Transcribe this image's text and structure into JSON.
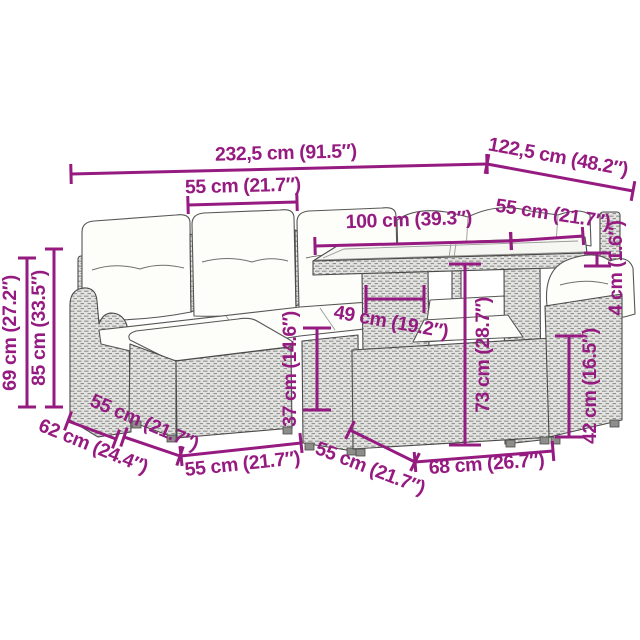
{
  "page": {
    "background": "#ffffff",
    "subject": "garden-lounge-furniture-set-dimension-diagram"
  },
  "colors": {
    "dimension": "#951B81",
    "outline": "#4a4a4a",
    "rattan_fill": "#e3e3e1",
    "rattan_stroke": "#91918e",
    "cushion": "#fdfdfa"
  },
  "dimensions": [
    {
      "id": "overall-width",
      "label": "232,5 cm (91.5″)",
      "text": {
        "x": 286,
        "y": 159,
        "rot": -1.4
      },
      "line": {
        "x1": 71,
        "y1": 174,
        "x2": 487,
        "y2": 164
      },
      "tick": 20
    },
    {
      "id": "overall-depth",
      "label": "122,5 cm (48.2″)",
      "text": {
        "x": 557,
        "y": 163,
        "rot": 10.5
      },
      "line": {
        "x1": 487,
        "y1": 164,
        "x2": 633,
        "y2": 191
      },
      "tick": 20
    },
    {
      "id": "seat-width",
      "label": "55 cm (21.7″)",
      "text": {
        "x": 243,
        "y": 192,
        "rot": -1.4
      },
      "line": {
        "x1": 188,
        "y1": 205,
        "x2": 297,
        "y2": 202
      },
      "tick": 18
    },
    {
      "id": "table-length",
      "label": "100 cm (39.3″)",
      "text": {
        "x": 409,
        "y": 226,
        "rot": -2
      },
      "line": {
        "x1": 315,
        "y1": 246,
        "x2": 511,
        "y2": 241
      },
      "tick": 18
    },
    {
      "id": "table-width",
      "label": "55 cm (21.7″)",
      "text": {
        "x": 552,
        "y": 220,
        "rot": 8.5
      },
      "line": {
        "x1": 511,
        "y1": 241,
        "x2": 583,
        "y2": 236
      },
      "tick": 18
    },
    {
      "id": "tabletop-thickness",
      "label": "4 cm (1.6″)",
      "text": {
        "x": 622,
        "y": 268,
        "rot": -90
      },
      "segments": [
        {
          "x1": 584,
          "y1": 253,
          "x2": 611,
          "y2": 253
        },
        {
          "x1": 584,
          "y1": 266,
          "x2": 611,
          "y2": 266
        },
        {
          "x1": 597,
          "y1": 253,
          "x2": 597,
          "y2": 266
        }
      ]
    },
    {
      "id": "arm-height",
      "label": "69 cm (27.2″)",
      "text": {
        "x": 16,
        "y": 333,
        "rot": -90
      },
      "line": {
        "x1": 27,
        "y1": 258,
        "x2": 27,
        "y2": 407
      },
      "tick": 18
    },
    {
      "id": "back-height",
      "label": "85 cm (33.5″)",
      "text": {
        "x": 45,
        "y": 328,
        "rot": -90
      },
      "line": {
        "x1": 54,
        "y1": 249,
        "x2": 54,
        "y2": 407
      },
      "tick": 18
    },
    {
      "id": "table-panel-width",
      "label": "49 cm (19.2″)",
      "text": {
        "x": 390,
        "y": 328,
        "rot": 10
      },
      "line": {
        "x1": 366,
        "y1": 299,
        "x2": 424,
        "y2": 299
      },
      "tick": 28
    },
    {
      "id": "ottoman-height",
      "label": "37 cm (14.6″)",
      "text": {
        "x": 296,
        "y": 369,
        "rot": -90
      },
      "line": {
        "x1": 317,
        "y1": 328,
        "x2": 317,
        "y2": 410
      },
      "tick": 28
    },
    {
      "id": "table-height",
      "label": "73 cm (28.7″)",
      "text": {
        "x": 489,
        "y": 355,
        "rot": -90
      },
      "line": {
        "x1": 465,
        "y1": 264,
        "x2": 465,
        "y2": 445
      },
      "tick": 32
    },
    {
      "id": "chair-seat-height",
      "label": "42 cm (16.5″)",
      "text": {
        "x": 596,
        "y": 386,
        "rot": -90
      },
      "line": {
        "x1": 569,
        "y1": 336,
        "x2": 569,
        "y2": 437
      },
      "tick": 28
    },
    {
      "id": "sofa-depth",
      "label": "62 cm (24.4″)",
      "text": {
        "x": 91,
        "y": 452,
        "rot": 22
      },
      "line": {
        "x1": 68,
        "y1": 421,
        "x2": 116,
        "y2": 439
      },
      "tick": 20
    },
    {
      "id": "seat-depth",
      "label": "55 cm (21.7″)",
      "text": {
        "x": 142,
        "y": 428,
        "rot": 23
      },
      "line": {
        "x1": 124,
        "y1": 437,
        "x2": 180,
        "y2": 456
      },
      "tick": 20
    },
    {
      "id": "ottoman-width",
      "label": "55 cm (21.7″)",
      "text": {
        "x": 243,
        "y": 470,
        "rot": -6
      },
      "line": {
        "x1": 181,
        "y1": 456,
        "x2": 301,
        "y2": 443
      },
      "tick": 20
    },
    {
      "id": "chair-depth",
      "label": "55 cm (21.7″)",
      "text": {
        "x": 368,
        "y": 474,
        "rot": 21
      },
      "line": {
        "x1": 350,
        "y1": 430,
        "x2": 415,
        "y2": 462
      },
      "tick": 20
    },
    {
      "id": "chair-width",
      "label": "68 cm (26.7″)",
      "text": {
        "x": 487,
        "y": 470,
        "rot": -4
      },
      "line": {
        "x1": 415,
        "y1": 462,
        "x2": 553,
        "y2": 451
      },
      "tick": 20
    }
  ]
}
